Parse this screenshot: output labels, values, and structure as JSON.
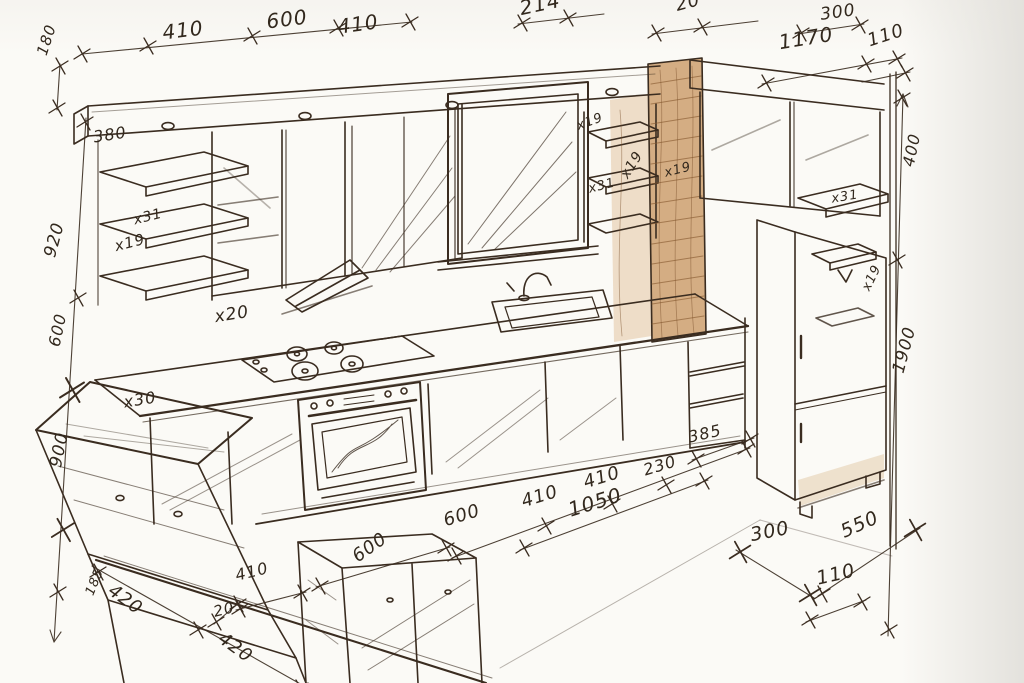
{
  "sketch": {
    "ink_color": "#3a2c20",
    "paper_color": "#fbfaf6",
    "wood_accent_color": "#cd9f6e"
  },
  "annotations": [
    {
      "kind": "dimension",
      "text": "180"
    },
    {
      "kind": "dimension",
      "text": "410"
    },
    {
      "kind": "dimension",
      "text": "600"
    },
    {
      "kind": "dimension",
      "text": "410"
    },
    {
      "kind": "dimension",
      "text": "214"
    },
    {
      "kind": "dimension",
      "text": "20"
    },
    {
      "kind": "dimension",
      "text": "300"
    },
    {
      "kind": "dimension",
      "text": "1170"
    },
    {
      "kind": "dimension",
      "text": "110"
    },
    {
      "kind": "dimension",
      "text": "400"
    },
    {
      "kind": "dimension",
      "text": "1900"
    },
    {
      "kind": "dimension",
      "text": "920"
    },
    {
      "kind": "dimension",
      "text": "600"
    },
    {
      "kind": "dimension",
      "text": "900"
    },
    {
      "kind": "dimension",
      "text": "185"
    },
    {
      "kind": "dimension",
      "text": "420"
    },
    {
      "kind": "dimension",
      "text": "420"
    },
    {
      "kind": "dimension",
      "text": "20"
    },
    {
      "kind": "dimension",
      "text": "410"
    },
    {
      "kind": "dimension",
      "text": "600"
    },
    {
      "kind": "dimension",
      "text": "600"
    },
    {
      "kind": "dimension",
      "text": "410"
    },
    {
      "kind": "dimension",
      "text": "410"
    },
    {
      "kind": "dimension",
      "text": "230"
    },
    {
      "kind": "dimension",
      "text": "1050"
    },
    {
      "kind": "dimension",
      "text": "385"
    },
    {
      "kind": "dimension",
      "text": "300"
    },
    {
      "kind": "dimension",
      "text": "550"
    },
    {
      "kind": "dimension",
      "text": "110"
    },
    {
      "kind": "dimension",
      "text": "380"
    },
    {
      "kind": "count",
      "text": "x31"
    },
    {
      "kind": "count",
      "text": "x19"
    },
    {
      "kind": "count",
      "text": "x20"
    },
    {
      "kind": "count",
      "text": "x30"
    },
    {
      "kind": "count",
      "text": "x19"
    },
    {
      "kind": "count",
      "text": "x19"
    },
    {
      "kind": "count",
      "text": "x19"
    },
    {
      "kind": "count",
      "text": "x31"
    },
    {
      "kind": "count",
      "text": "x31"
    },
    {
      "kind": "count",
      "text": "x19"
    }
  ]
}
